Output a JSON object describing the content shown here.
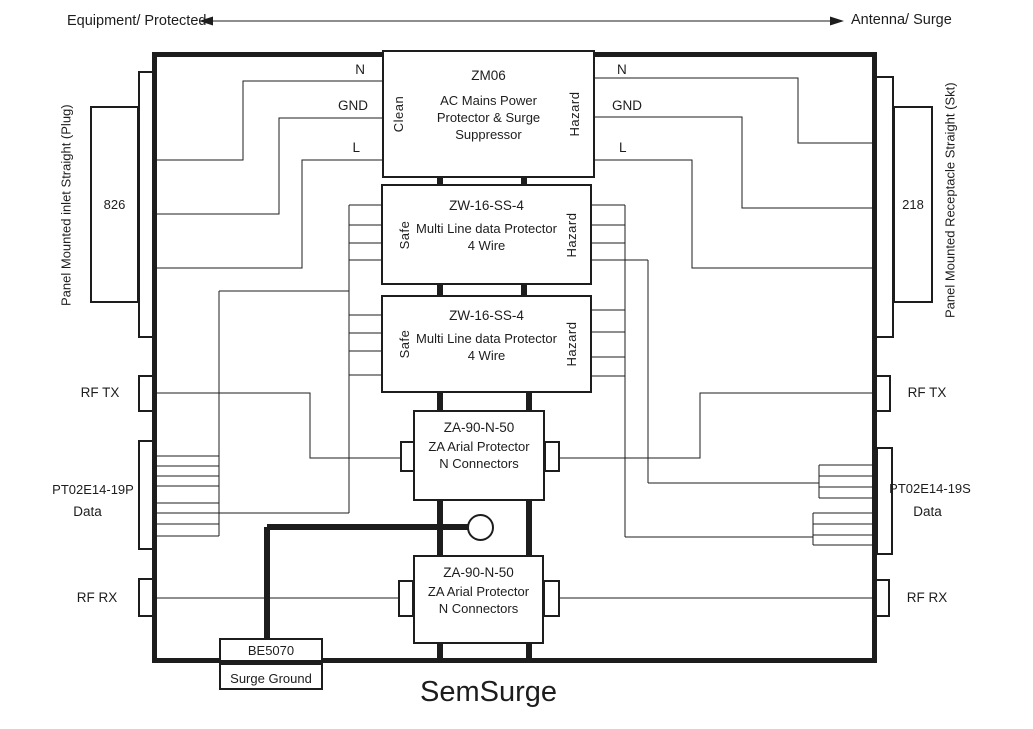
{
  "title": "SemSurge",
  "colors": {
    "ink": "#1d1d1d",
    "background": "#ffffff"
  },
  "header": {
    "left_arrow_label": "Equipment/ Protected",
    "right_arrow_label": "Antenna/ Surge"
  },
  "left_panel": {
    "vertical_label": "Panel Mounted inlet Straight (Plug)",
    "connector": "826",
    "rf_tx": "RF TX",
    "data_part": "PT02E14-19P",
    "data_word": "Data",
    "rf_rx": "RF RX"
  },
  "right_panel": {
    "vertical_label": "Panel Mounted Receptacle Straight (Skt)",
    "connector": "218",
    "rf_tx": "RF TX",
    "data_part": "PT02E14-19S",
    "data_word": "Data",
    "rf_rx": "RF RX"
  },
  "mains_wires": {
    "left": {
      "n": "N",
      "gnd": "GND",
      "l": "L"
    },
    "right": {
      "n": "N",
      "gnd": "GND",
      "l": "L"
    }
  },
  "blocks": {
    "zm06": {
      "part": "ZM06",
      "desc1": "AC Mains Power",
      "desc2": "Protector & Surge",
      "desc3": "Suppressor",
      "left_zone": "Clean",
      "right_zone": "Hazard"
    },
    "zw_upper": {
      "part": "ZW-16-SS-4",
      "desc1": "Multi Line data Protector",
      "desc2": "4 Wire",
      "left_zone": "Safe",
      "right_zone": "Hazard"
    },
    "zw_lower": {
      "part": "ZW-16-SS-4",
      "desc1": "Multi Line data Protector",
      "desc2": "4 Wire",
      "left_zone": "Safe",
      "right_zone": "Hazard"
    },
    "za_upper": {
      "part": "ZA-90-N-50",
      "desc1": "ZA Arial Protector",
      "desc2": "N Connectors"
    },
    "za_lower": {
      "part": "ZA-90-N-50",
      "desc1": "ZA Arial Protector",
      "desc2": "N Connectors"
    },
    "ground": {
      "part": "BE5070",
      "desc": "Surge Ground"
    }
  }
}
